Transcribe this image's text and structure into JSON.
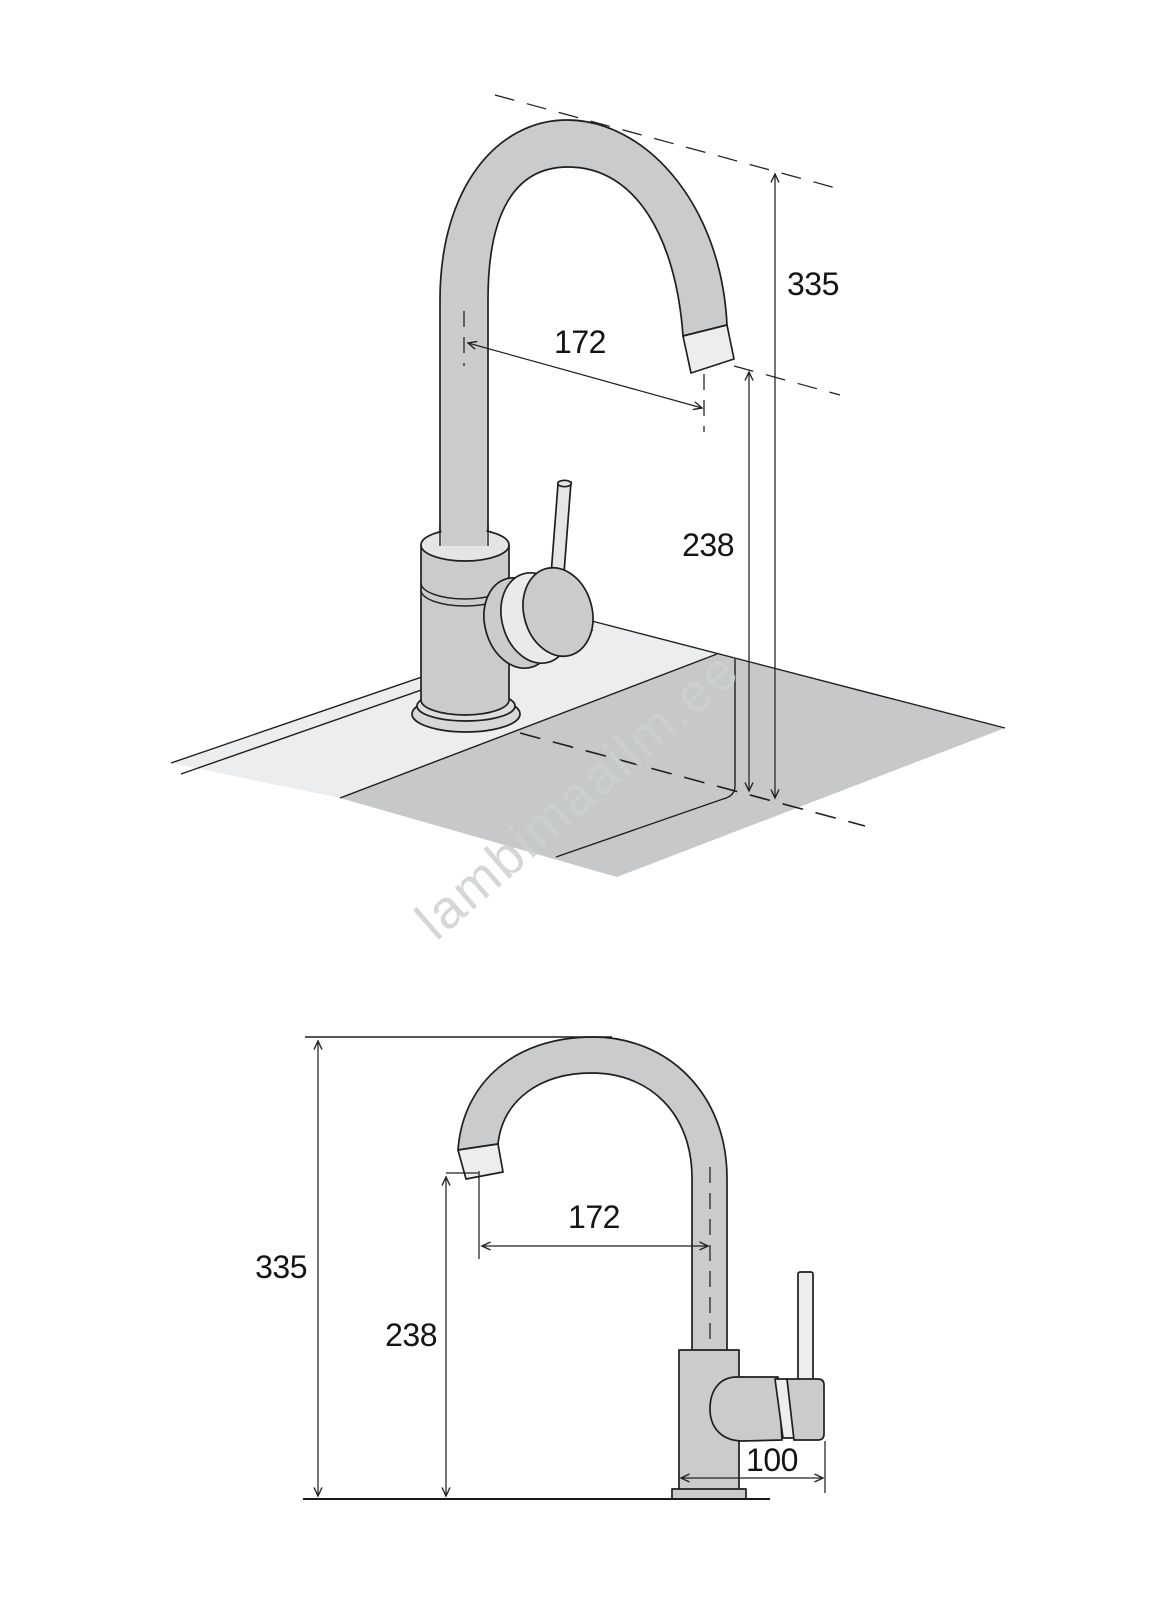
{
  "watermark": "lambimaailm.ee",
  "colors": {
    "faucet_gray": "#c9cbcc",
    "tip_light": "#ededee",
    "cap_light": "#e3e5e6",
    "deck_light": "#ecedee",
    "basin_gray": "#c6c8c9",
    "flange_gray": "#d5d7d8",
    "watermark_gray": "#ccd1ce"
  },
  "perspective_view": {
    "dim_total_height": "335",
    "dim_spout_reach": "172",
    "dim_spout_height": "238"
  },
  "side_view": {
    "dim_total_height": "335",
    "dim_spout_height": "238",
    "dim_spout_reach": "172",
    "dim_base_depth": "100"
  }
}
